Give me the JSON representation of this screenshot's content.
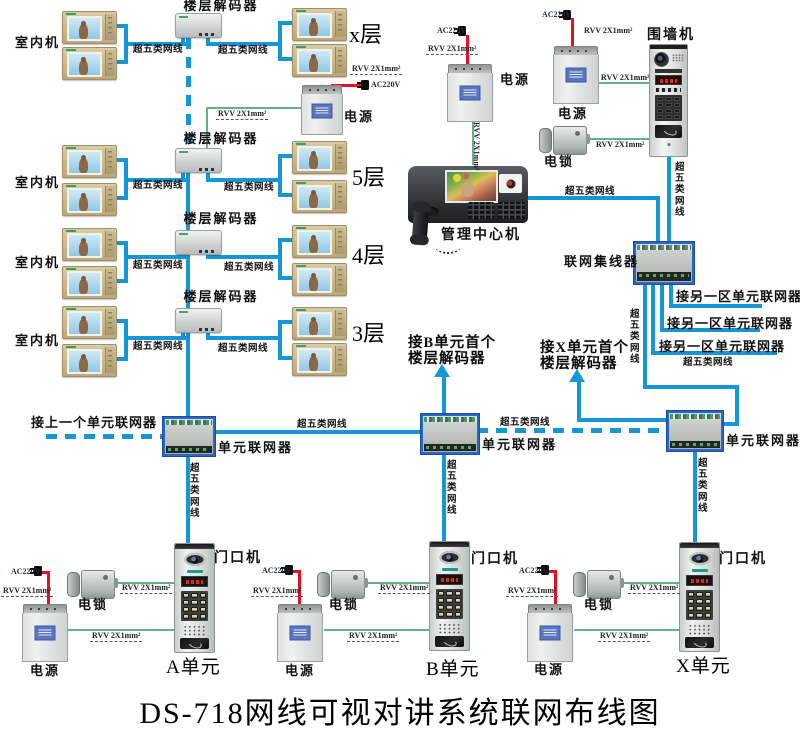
{
  "title": "DS-718网线可视对讲系统联网布线图",
  "labels": {
    "floor_decoder": "楼层解码器",
    "indoor_unit": "室内机",
    "cat5": "超五类网线",
    "power_supply": "电源",
    "electric_lock": "电锁",
    "door_station": "门口机",
    "management_center": "管理中心机",
    "wall_station": "围墙机",
    "network_hub": "联网集线器",
    "unit_networker": "单元联网器",
    "to_prev_networker": "接上一个单元联网器",
    "to_other_zone_networker": "接另一区单元联网器",
    "to_b_unit_line1": "接B单元首个",
    "to_x_unit_line1": "接X单元首个",
    "rvv_cable": "RVV 2X1mm²",
    "ac_power": "AC220V"
  },
  "floors": [
    "x层",
    "5层",
    "4层",
    "3层"
  ],
  "units": [
    "A单元",
    "B单元",
    "X单元"
  ],
  "colors": {
    "cable_blue": "#1496d7",
    "cable_green": "#63b287",
    "cable_red": "#e8101e"
  }
}
